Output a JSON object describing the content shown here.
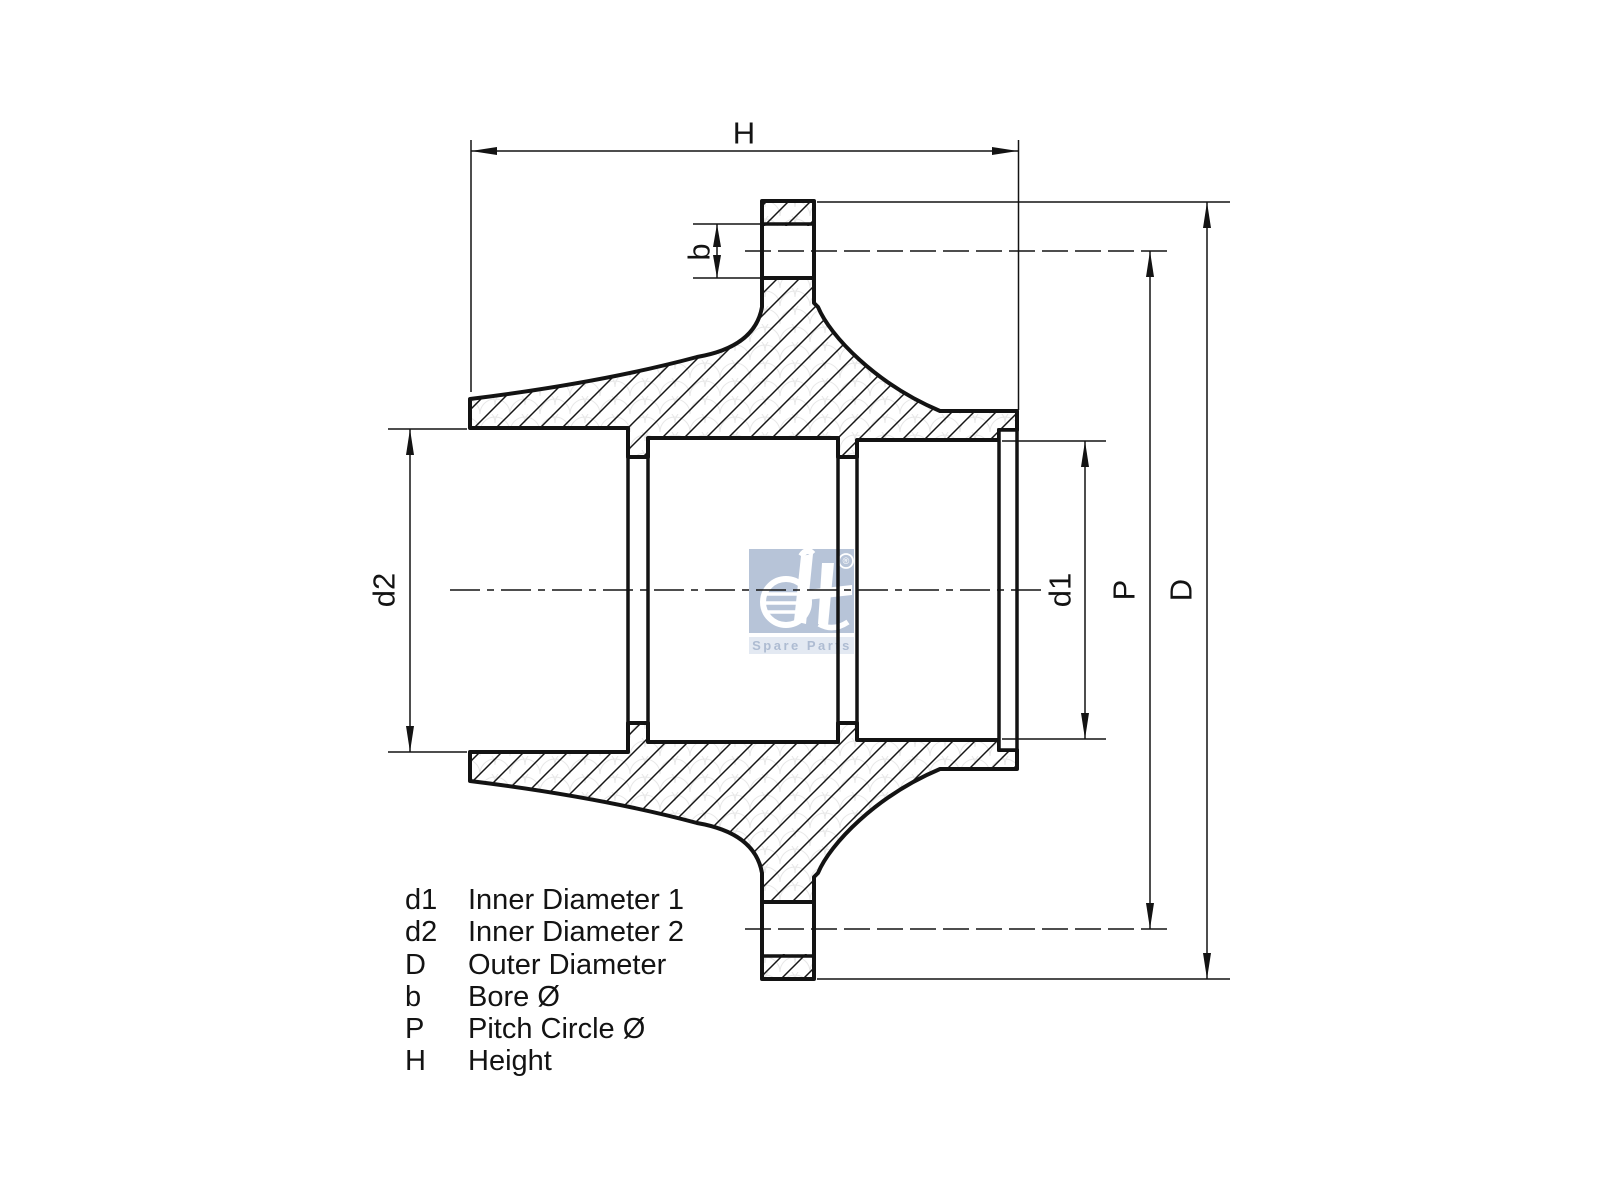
{
  "drawing": {
    "labels": {
      "h": "H",
      "b": "b",
      "d1": "d1",
      "d2": "d2",
      "p": "P",
      "d_outer": "D"
    },
    "colors": {
      "line": "#131313",
      "watermark_box": "#b7c4d8",
      "watermark_band": "#e3e9f2",
      "watermark_text": "#aebcd2"
    }
  },
  "watermark": {
    "brand": "dt",
    "registered": "®",
    "subtitle": "Spare Parts"
  },
  "legend": {
    "rows": [
      {
        "symbol": "d1",
        "description": "Inner Diameter 1"
      },
      {
        "symbol": "d2",
        "description": "Inner Diameter 2"
      },
      {
        "symbol": "D",
        "description": "Outer Diameter"
      },
      {
        "symbol": "b",
        "description": "Bore Ø"
      },
      {
        "symbol": "P",
        "description": "Pitch Circle Ø"
      },
      {
        "symbol": "H",
        "description": "Height"
      }
    ]
  }
}
